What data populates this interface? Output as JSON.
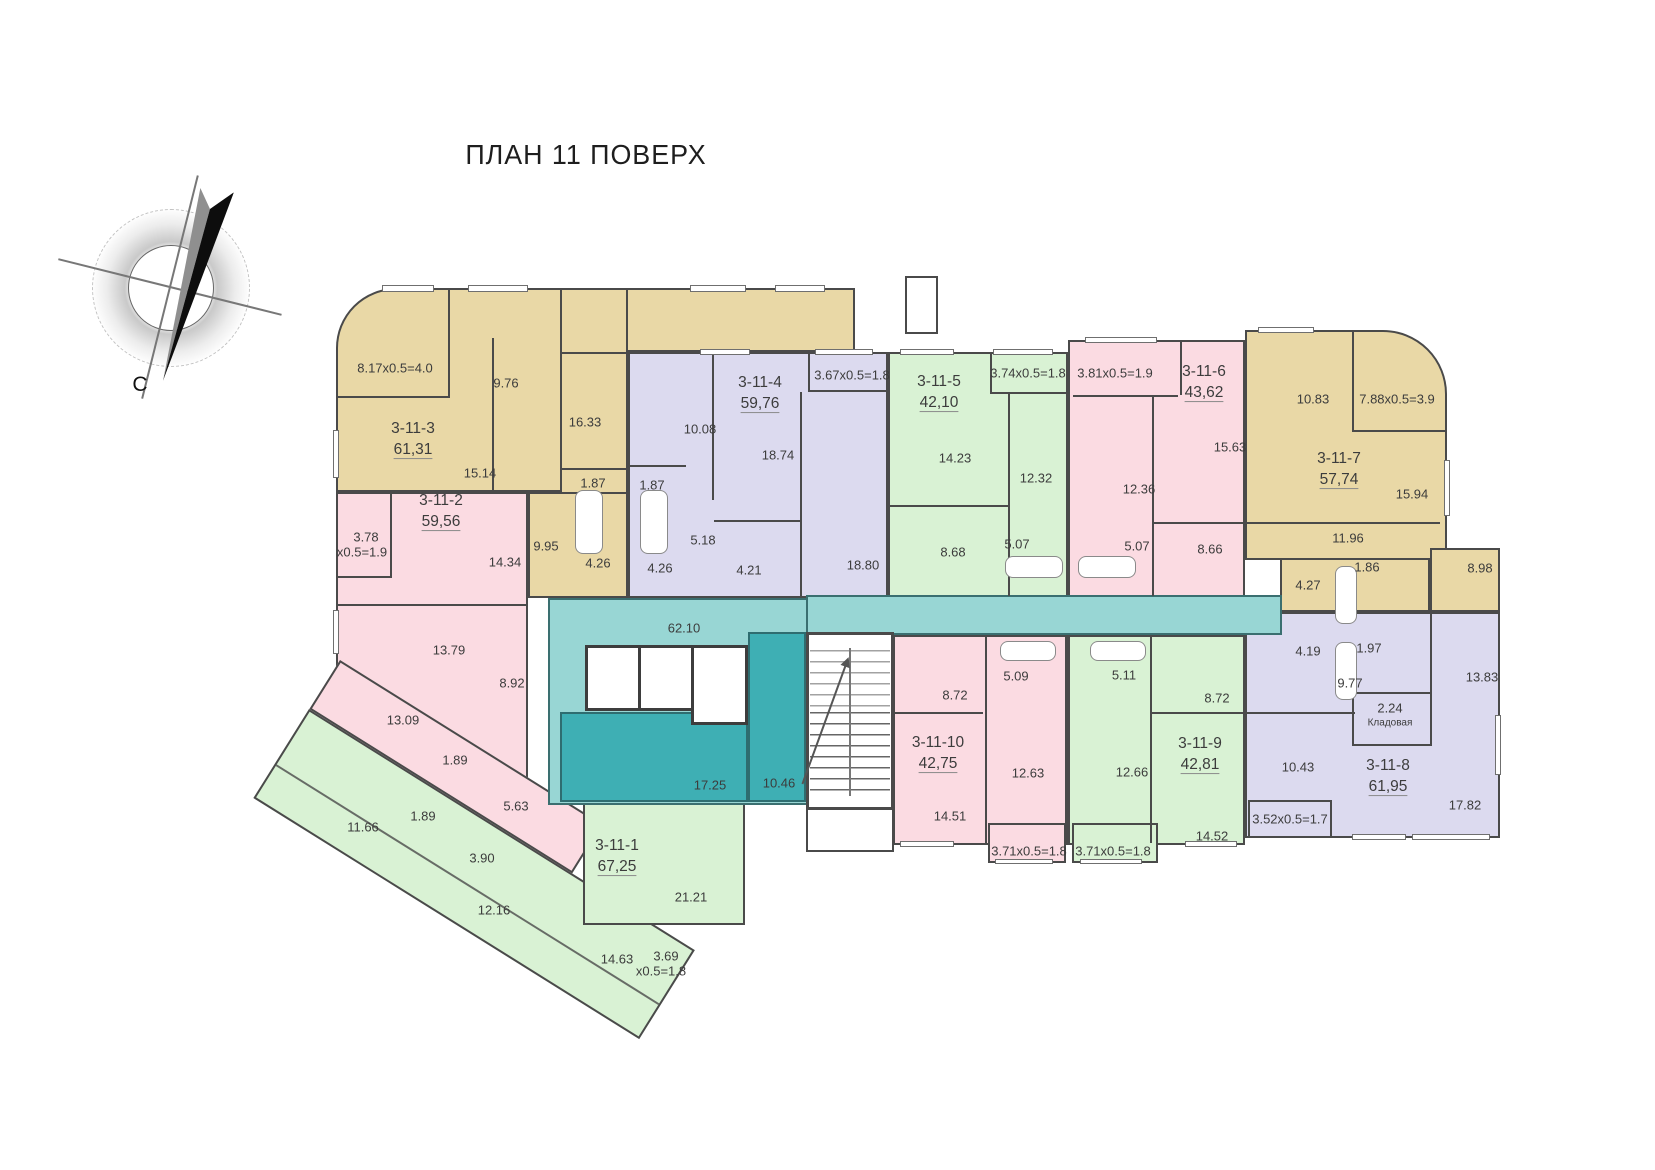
{
  "title": "ПЛАН 11 ПОВЕРХ",
  "compass": {
    "north_label": "С"
  },
  "palette": {
    "tan": "#e9d8a6",
    "lavender": "#dcdaef",
    "pink": "#fbdbe2",
    "green": "#d9f2d4",
    "corridor_teal": "#98d6d4",
    "lobby_teal_dark": "#3eafb4",
    "wall": "#4a4a4a",
    "text": "#3c3c3c"
  },
  "apartments": [
    {
      "id": "3-11-1",
      "area": "67,25",
      "color": "green",
      "x": 617,
      "y": 857
    },
    {
      "id": "3-11-2",
      "area": "59,56",
      "color": "pink",
      "x": 441,
      "y": 512
    },
    {
      "id": "3-11-3",
      "area": "61,31",
      "color": "tan",
      "x": 413,
      "y": 440
    },
    {
      "id": "3-11-4",
      "area": "59,76",
      "color": "lavender",
      "x": 760,
      "y": 394
    },
    {
      "id": "3-11-5",
      "area": "42,10",
      "color": "green",
      "x": 939,
      "y": 393
    },
    {
      "id": "3-11-6",
      "area": "43,62",
      "color": "pink",
      "x": 1204,
      "y": 383
    },
    {
      "id": "3-11-7",
      "area": "57,74",
      "color": "tan",
      "x": 1339,
      "y": 470
    },
    {
      "id": "3-11-8",
      "area": "61,95",
      "color": "lavender",
      "x": 1388,
      "y": 777
    },
    {
      "id": "3-11-9",
      "area": "42,81",
      "color": "green",
      "x": 1200,
      "y": 755
    },
    {
      "id": "3-11-10",
      "area": "42,75",
      "color": "pink",
      "x": 938,
      "y": 754
    }
  ],
  "room_labels": [
    {
      "t": "8.17x0.5=4.0",
      "x": 395,
      "y": 368,
      "region": "3-11-3"
    },
    {
      "t": "9.76",
      "x": 506,
      "y": 383,
      "region": "3-11-3"
    },
    {
      "t": "16.33",
      "x": 585,
      "y": 422,
      "region": "3-11-3"
    },
    {
      "t": "15.14",
      "x": 480,
      "y": 473,
      "region": "3-11-3"
    },
    {
      "t": "1.87",
      "x": 593,
      "y": 483,
      "region": "3-11-3"
    },
    {
      "t": "9.95",
      "x": 546,
      "y": 546,
      "region": "3-11-3"
    },
    {
      "t": "4.26",
      "x": 598,
      "y": 563,
      "region": "3-11-3"
    },
    {
      "t": "3.78",
      "x": 366,
      "y": 537,
      "region": "3-11-2"
    },
    {
      "t": "x0.5=1.9",
      "x": 362,
      "y": 552,
      "region": "3-11-2"
    },
    {
      "t": "14.34",
      "x": 505,
      "y": 562,
      "region": "3-11-2"
    },
    {
      "t": "13.79",
      "x": 449,
      "y": 650,
      "region": "3-11-2"
    },
    {
      "t": "8.92",
      "x": 512,
      "y": 683,
      "region": "3-11-2"
    },
    {
      "t": "13.09",
      "x": 403,
      "y": 720,
      "region": "3-11-2"
    },
    {
      "t": "1.89",
      "x": 455,
      "y": 760,
      "region": "3-11-2"
    },
    {
      "t": "5.63",
      "x": 516,
      "y": 806,
      "region": "3-11-2"
    },
    {
      "t": "1.89",
      "x": 423,
      "y": 816,
      "region": "3-11-1"
    },
    {
      "t": "11.66",
      "x": 363,
      "y": 827,
      "region": "3-11-1"
    },
    {
      "t": "3.90",
      "x": 482,
      "y": 858,
      "region": "3-11-1"
    },
    {
      "t": "12.16",
      "x": 494,
      "y": 910,
      "region": "3-11-1"
    },
    {
      "t": "21.21",
      "x": 691,
      "y": 897,
      "region": "3-11-1"
    },
    {
      "t": "14.63",
      "x": 617,
      "y": 959,
      "region": "3-11-1"
    },
    {
      "t": "3.69",
      "x": 666,
      "y": 956,
      "region": "3-11-1"
    },
    {
      "t": "x0.5=1.8",
      "x": 661,
      "y": 971,
      "region": "3-11-1"
    },
    {
      "t": "10.08",
      "x": 700,
      "y": 429,
      "region": "3-11-4"
    },
    {
      "t": "18.74",
      "x": 778,
      "y": 455,
      "region": "3-11-4"
    },
    {
      "t": "3.67x0.5=1.8",
      "x": 852,
      "y": 375,
      "region": "3-11-4"
    },
    {
      "t": "1.87",
      "x": 652,
      "y": 485,
      "region": "3-11-4"
    },
    {
      "t": "5.18",
      "x": 703,
      "y": 540,
      "region": "3-11-4"
    },
    {
      "t": "4.26",
      "x": 660,
      "y": 568,
      "region": "3-11-4"
    },
    {
      "t": "4.21",
      "x": 749,
      "y": 570,
      "region": "3-11-4"
    },
    {
      "t": "18.80",
      "x": 863,
      "y": 565,
      "region": "3-11-4"
    },
    {
      "t": "3.74x0.5=1.8",
      "x": 1028,
      "y": 373,
      "region": "3-11-5"
    },
    {
      "t": "14.23",
      "x": 955,
      "y": 458,
      "region": "3-11-5"
    },
    {
      "t": "12.32",
      "x": 1036,
      "y": 478,
      "region": "3-11-5"
    },
    {
      "t": "8.68",
      "x": 953,
      "y": 552,
      "region": "3-11-5"
    },
    {
      "t": "5.07",
      "x": 1017,
      "y": 544,
      "region": "3-11-5"
    },
    {
      "t": "3.81x0.5=1.9",
      "x": 1115,
      "y": 373,
      "region": "3-11-6"
    },
    {
      "t": "15.63",
      "x": 1230,
      "y": 447,
      "region": "3-11-6"
    },
    {
      "t": "12.36",
      "x": 1139,
      "y": 489,
      "region": "3-11-6"
    },
    {
      "t": "5.07",
      "x": 1137,
      "y": 546,
      "region": "3-11-6"
    },
    {
      "t": "8.66",
      "x": 1210,
      "y": 549,
      "region": "3-11-6"
    },
    {
      "t": "10.83",
      "x": 1313,
      "y": 399,
      "region": "3-11-7"
    },
    {
      "t": "7.88x0.5=3.9",
      "x": 1397,
      "y": 399,
      "region": "3-11-7"
    },
    {
      "t": "15.94",
      "x": 1412,
      "y": 494,
      "region": "3-11-7"
    },
    {
      "t": "11.96",
      "x": 1348,
      "y": 538,
      "region": "3-11-7"
    },
    {
      "t": "1.86",
      "x": 1367,
      "y": 567,
      "region": "3-11-7"
    },
    {
      "t": "8.98",
      "x": 1480,
      "y": 568,
      "region": "3-11-7"
    },
    {
      "t": "4.27",
      "x": 1308,
      "y": 585,
      "region": "3-11-7"
    },
    {
      "t": "4.19",
      "x": 1308,
      "y": 651,
      "region": "3-11-8"
    },
    {
      "t": "1.97",
      "x": 1369,
      "y": 648,
      "region": "3-11-8"
    },
    {
      "t": "9.77",
      "x": 1350,
      "y": 683,
      "region": "3-11-8"
    },
    {
      "t": "13.83",
      "x": 1482,
      "y": 677,
      "region": "3-11-8"
    },
    {
      "t": "2.24",
      "x": 1390,
      "y": 708,
      "region": "3-11-8"
    },
    {
      "t": "Кладовая",
      "x": 1390,
      "y": 723,
      "region": "3-11-8",
      "s": true
    },
    {
      "t": "10.43",
      "x": 1298,
      "y": 767,
      "region": "3-11-8"
    },
    {
      "t": "17.82",
      "x": 1465,
      "y": 805,
      "region": "3-11-8"
    },
    {
      "t": "3.52x0.5=1.7",
      "x": 1290,
      "y": 819,
      "region": "3-11-8"
    },
    {
      "t": "5.11",
      "x": 1124,
      "y": 675,
      "region": "3-11-9"
    },
    {
      "t": "8.72",
      "x": 1217,
      "y": 698,
      "region": "3-11-9"
    },
    {
      "t": "12.66",
      "x": 1132,
      "y": 772,
      "region": "3-11-9"
    },
    {
      "t": "14.52",
      "x": 1212,
      "y": 836,
      "region": "3-11-9"
    },
    {
      "t": "3.71x0.5=1.8",
      "x": 1113,
      "y": 851,
      "region": "3-11-9"
    },
    {
      "t": "8.72",
      "x": 955,
      "y": 695,
      "region": "3-11-10"
    },
    {
      "t": "5.09",
      "x": 1016,
      "y": 676,
      "region": "3-11-10"
    },
    {
      "t": "12.63",
      "x": 1028,
      "y": 773,
      "region": "3-11-10"
    },
    {
      "t": "14.51",
      "x": 950,
      "y": 816,
      "region": "3-11-10"
    },
    {
      "t": "3.71x0.5=1.8",
      "x": 1029,
      "y": 851,
      "region": "3-11-10"
    },
    {
      "t": "62.10",
      "x": 684,
      "y": 628,
      "region": "corridor"
    },
    {
      "t": "17.25",
      "x": 710,
      "y": 785,
      "region": "lobby"
    },
    {
      "t": "10.46",
      "x": 779,
      "y": 783,
      "region": "vestibule"
    }
  ]
}
